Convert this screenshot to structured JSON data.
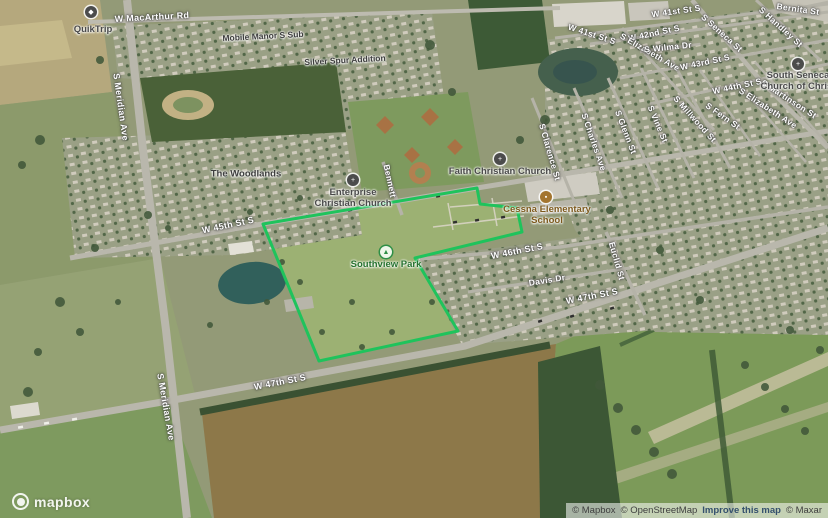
{
  "streets": [
    {
      "text": "W MacArthur Rd"
    },
    {
      "text": "S Meridian Ave"
    },
    {
      "text": "S Meridian Ave"
    },
    {
      "text": "W 45th St S"
    },
    {
      "text": "W 46th St S"
    },
    {
      "text": "W 47th St S"
    },
    {
      "text": "W 47th St S"
    },
    {
      "text": "Euclid St"
    },
    {
      "text": "Davis Dr"
    },
    {
      "text": "Bennett"
    },
    {
      "text": "S Clarence St"
    },
    {
      "text": "S Charles Ave"
    },
    {
      "text": "S Glenn St"
    },
    {
      "text": "S Vine St"
    },
    {
      "text": "S Millwood St"
    },
    {
      "text": "S Seneca St"
    },
    {
      "text": "S Handley St"
    },
    {
      "text": "Bernita St"
    },
    {
      "text": "W 41st St S"
    },
    {
      "text": "W 41st St S"
    },
    {
      "text": "W 42nd St S"
    },
    {
      "text": "S Elizabeth Ave"
    },
    {
      "text": "S Elizabeth Ave"
    },
    {
      "text": "S Wilma Dr"
    },
    {
      "text": "W 43rd St S"
    },
    {
      "text": "W 44th St S"
    },
    {
      "text": "S Martinson St"
    },
    {
      "text": "S Fern St"
    }
  ],
  "places": [
    {
      "text": "The Woodlands"
    },
    {
      "text": "Mobile Manor S Sub"
    },
    {
      "text": "Silver Spur Addition"
    }
  ],
  "pois": [
    {
      "name": "QuikTrip"
    },
    {
      "line1": "Enterprise",
      "line2": "Christian Church"
    },
    {
      "name": "Faith Christian Church"
    },
    {
      "line1": "South Seneca",
      "line2": "Church of Christ"
    },
    {
      "line1": "Cessna Elementary",
      "line2": "School"
    },
    {
      "name": "Southview Park"
    }
  ],
  "icons": {
    "church_glyph": "+",
    "school_glyph": "▪",
    "store_glyph": "◆",
    "park_glyph": "▲"
  },
  "park_overlay": {
    "name": "Southview Park",
    "outline_color": "#1fc35c"
  },
  "attribution": {
    "mapbox": "© Mapbox",
    "osm": "© OpenStreetMap",
    "improve": "Improve this map",
    "maxar": "© Maxar"
  },
  "logo": {
    "label": "mapbox"
  }
}
